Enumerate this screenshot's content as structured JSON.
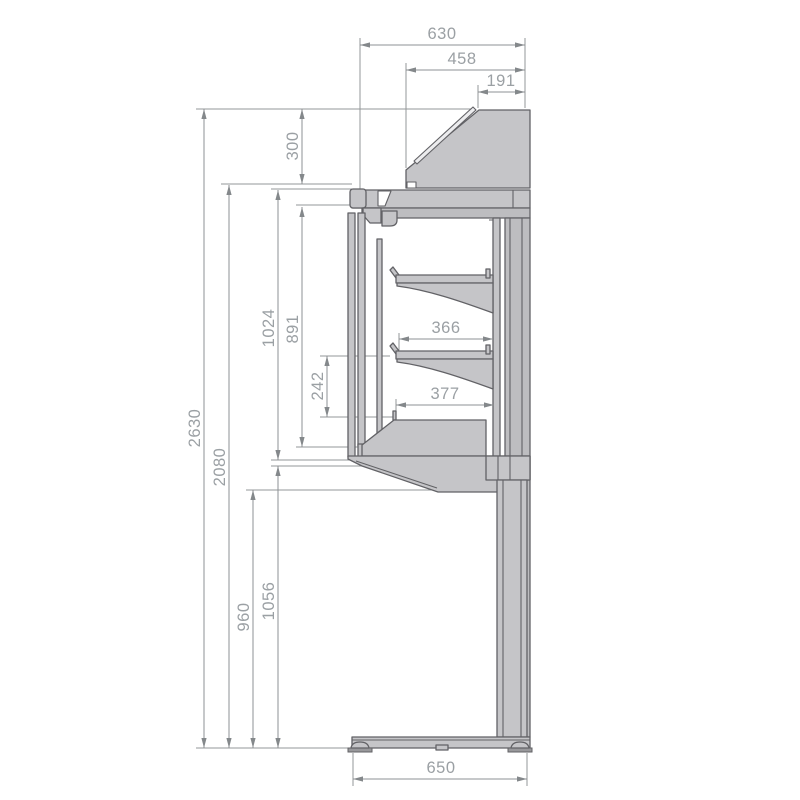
{
  "drawing": {
    "kind": "technical-dimension-drawing",
    "subject": "refrigerated-display-case-side-section",
    "colors": {
      "background": "#ffffff",
      "body_fill": "#c5c5c8",
      "panel_fill": "#bdbdc0",
      "outline": "#626266",
      "dimension_line": "#8d9194",
      "dimension_text": "#9ba0a4"
    }
  },
  "dims": {
    "d630": "630",
    "d458": "458",
    "d191": "191",
    "d300": "300",
    "d2630": "2630",
    "d2080": "2080",
    "d1024": "1024",
    "d891": "891",
    "d242": "242",
    "d366": "366",
    "d377": "377",
    "d960": "960",
    "d1056": "1056",
    "d650": "650"
  }
}
